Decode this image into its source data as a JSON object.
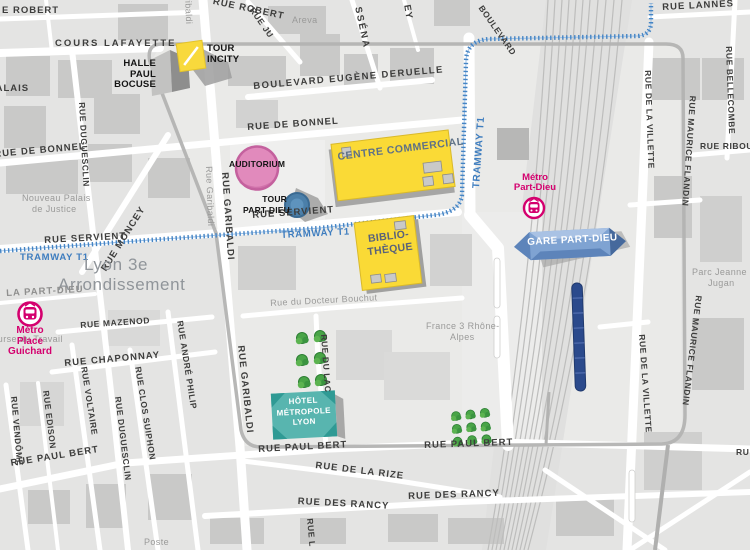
{
  "colors": {
    "landmark_yellow": "#fada36",
    "metro_pink": "#d4006e",
    "tram_blue": "#4484c4",
    "auditorium_pink": "#e18abc",
    "hotel_teal": "#58b5af",
    "gare_blue": "#8aabd6",
    "train_navy": "#2b4a8c"
  },
  "streets": {
    "robert_left": "E ROBERT",
    "robert_top": "RUE ROBERT",
    "juliette": "RUE JU",
    "massena": "SSÉNA",
    "ney": "EY",
    "lannes": "RUE LANNES",
    "cours_lafayette": "COURS LAFAYETTE",
    "palais_cut": "PALAIS",
    "bonnel": "RUE DE BONNEL",
    "deruelle": "BOULEVARD EUGÈNE DERUELLE",
    "boulevard": "BOULEVARD",
    "servient": "RUE SERVIENT",
    "garibaldi_small": "Rue Garibaldi",
    "garibaldi": "RUE GARIBALDI",
    "duguesclin": "RUE DUGUESCLIN",
    "vendome": "RUE VENDÔME",
    "edison": "RUE EDISON",
    "voltaire": "RUE VOLTAIRE",
    "clos_suiphon": "RUE CLOS SUIPHON",
    "andre_philip": "RUE ANDRÉ PHILIP",
    "moncey": "RUE MONCEY",
    "mazenod": "RUE MAZENOD",
    "chaponnay": "RUE CHAPONNAY",
    "paul_bert": "RUE PAUL BERT",
    "rize": "RUE DE LA RIZE",
    "rancy": "RUE DES RANCY",
    "lac": "RUE DU LAC",
    "bouchut": "Rue du Docteur Bouchut",
    "villette": "RUE DE LA VILLETTE",
    "flandin": "RUE MAURICE FLANDIN",
    "bellecombe": "RUE BELLECOMBE",
    "riboul": "RUE RIBOU",
    "frag_rue_l": "RUE L",
    "frag_ru": "RU"
  },
  "areas": {
    "areva": "Areva",
    "lyon3_1": "Lyon 3e",
    "lyon3_2": "Arrondissement",
    "la_part_dieu": "LA PART-DIEU",
    "palais_1": "Nouveau Palais",
    "palais_2": "de Justice",
    "bourse": "Bourse du Travail",
    "france3_1": "France 3 Rhône-",
    "france3_2": "Alpes",
    "parc_1": "Parc Jeanne",
    "parc_2": "Jugan",
    "poste": "Poste"
  },
  "transit": {
    "tramway": "TRAMWAY T1",
    "metro_pd_1": "Métro",
    "metro_pd_2": "Part-Dieu",
    "metro_g_1": "Métro",
    "metro_g_2": "Place",
    "metro_g_3": "Guichard",
    "gare": "GARE PART-DIEU"
  },
  "landmarks": {
    "centre_commercial": "CENTRE COMMERCIAL",
    "biblio_1": "BIBLIO-",
    "biblio_2": "THÈQUE",
    "auditorium": "AUDITORIUM",
    "tour_pd_1": "TOUR",
    "tour_pd_2": "PART-DIEU",
    "incity_1": "TOUR",
    "incity_2": "INCITY",
    "halle_1": "HALLE",
    "halle_2": "PAUL",
    "halle_3": "BOCUSE",
    "hotel_1": "HÔTEL",
    "hotel_2": "MÉTROPOLE",
    "hotel_3": "LYON"
  }
}
